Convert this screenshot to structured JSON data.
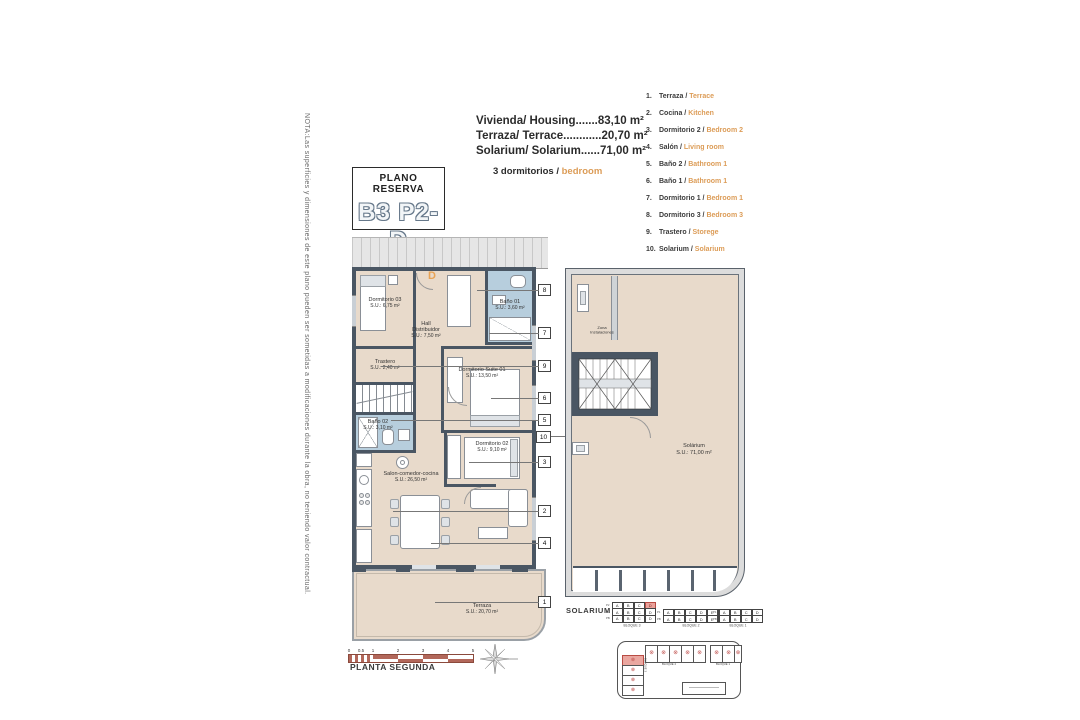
{
  "note": "NOTA:Las superficies y dimensiones de este plano pueden ser sometidas a modificaciones durante la obra, no teniendo valor contractual.",
  "title_box": {
    "kicker": "PLANO RESERVA",
    "code": "B3 P2-D"
  },
  "summary": {
    "lines": [
      {
        "label": "Vivienda/ Housing",
        "dots": ".......",
        "value": "83,10 m²"
      },
      {
        "label": "Terraza/ Terrace",
        "dots": "............",
        "value": "20,70 m²"
      },
      {
        "label": "Solarium/ Solarium",
        "dots": "......",
        "value": "71,00 m²"
      }
    ],
    "bedrooms_es": "3 dormitorios / ",
    "bedrooms_en": "bedroom"
  },
  "legend": {
    "items": [
      {
        "num": "1.",
        "es": "Terraza / ",
        "en": "Terrace"
      },
      {
        "num": "2.",
        "es": "Cocina / ",
        "en": "Kitchen"
      },
      {
        "num": "3.",
        "es": "Dormitorio 2 / ",
        "en": "Bedroom 2"
      },
      {
        "num": "4.",
        "es": "Salón / ",
        "en": "Living room"
      },
      {
        "num": "5.",
        "es": "Baño 2 / ",
        "en": "Bathroom 1"
      },
      {
        "num": "6.",
        "es": "Baño 1 / ",
        "en": "Bathroom 1"
      },
      {
        "num": "7.",
        "es": "Dormitorio 1 / ",
        "en": "Bedroom 1"
      },
      {
        "num": "8.",
        "es": "Dormitorio 3 / ",
        "en": "Bedroom 3"
      },
      {
        "num": "9.",
        "es": "Trastero / ",
        "en": "Storege"
      },
      {
        "num": "10.",
        "es": "Solarium / ",
        "en": "Solarium"
      }
    ]
  },
  "plan": {
    "unit_letter": "D",
    "rooms": {
      "dorm03": {
        "name": "Dormitorio 03",
        "area": "S.U.: 6,75 m²"
      },
      "bano01": {
        "name": "Baño 01",
        "area": "S.U.: 3,60 m²"
      },
      "hall": {
        "name": "Hall Distribuidor",
        "area": "S.U.: 7,50 m²"
      },
      "trastero": {
        "name": "Trastero",
        "area": "S.U.: 2,40 m²"
      },
      "suite01": {
        "name": "Dormitorio Suite 01",
        "area": "S.U.: 13,50 m²"
      },
      "bano02": {
        "name": "Baño 02",
        "area": "S.U.: 3,10 m²"
      },
      "dorm02": {
        "name": "Dormitorio 02",
        "area": "S.U.: 9,10 m²"
      },
      "salon": {
        "name": "Salon-comedor-cocina",
        "area": "S.U.: 26,50 m²"
      },
      "terraza": {
        "name": "Terraza",
        "area": "S.U.: 20,70 m²"
      }
    },
    "callouts": [
      "8",
      "7",
      "9",
      "6",
      "5",
      "10",
      "3",
      "2",
      "4",
      "1"
    ]
  },
  "solarium_plan": {
    "zona": "Zona\nInstalaciones",
    "room": "Solárium",
    "area": "S.U.: 71,00 m²",
    "caption": "SOLARIUM"
  },
  "scale_bar": {
    "ticks": [
      "0",
      "0.5",
      "1",
      "2",
      "3",
      "4",
      "5"
    ],
    "caption": "PLANTA SEGUNDA"
  },
  "key_tables": [
    {
      "caption": "BLOQUE 3",
      "row_labels": [
        "P2",
        "P1",
        "PB"
      ],
      "cols": [
        "A",
        "B",
        "C",
        "D"
      ],
      "highlight": {
        "row": 0,
        "col": 3
      }
    },
    {
      "caption": "BLOQUE 2",
      "row_labels": [
        "P1",
        "PB"
      ],
      "cols": [
        "A",
        "B",
        "C",
        "D",
        "E",
        "F"
      ],
      "highlight": null
    },
    {
      "caption": "BLOQUE 1",
      "row_labels": [
        "P1",
        "PB"
      ],
      "cols": [
        "A",
        "B",
        "C",
        "D"
      ],
      "highlight": null
    }
  ],
  "site_plan": {
    "block3": "BLOQUE 3",
    "block2": "BLOQUE 2",
    "block1": "BLOQUE 1"
  },
  "icons": {
    "unit_marker": "⊗"
  },
  "colors": {
    "accent_orange": "#dc9c57",
    "wall": "#4a5663",
    "room_beige": "#e8dacb",
    "bath_blue": "#b7cedd",
    "highlight_red": "#eaa29b",
    "scale_brick": "#b2675a"
  }
}
